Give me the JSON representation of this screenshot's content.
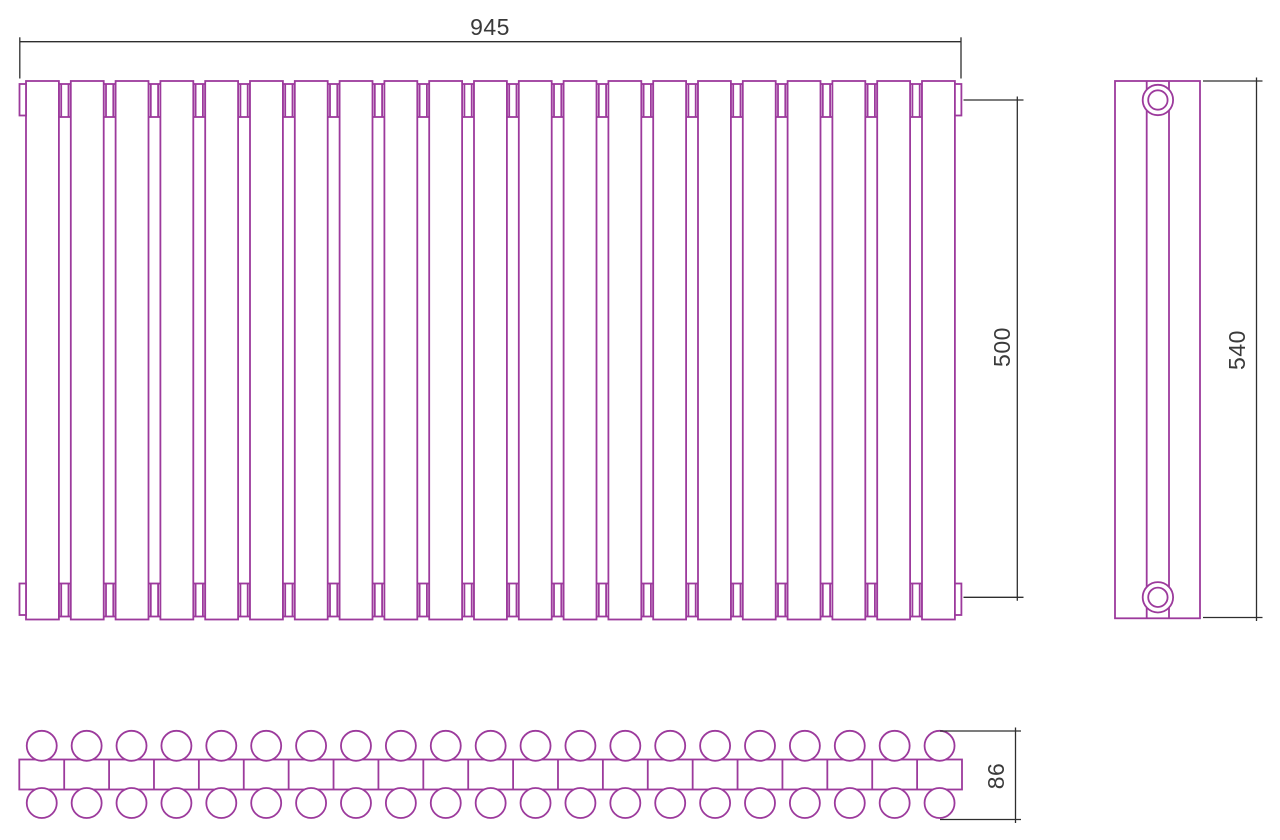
{
  "drawing_type": "radiator-three-view-technical-drawing",
  "dimensions": {
    "overall_width": "945",
    "axis_distance": "500",
    "overall_height": "540",
    "depth": "86"
  },
  "colors": {
    "line": "#9c3a9c",
    "dimension_line": "#2e2e2e",
    "dimension_text": "#3a3a3a",
    "background": "#ffffff"
  },
  "geometry": {
    "front": {
      "sections": 21,
      "col_left": 26,
      "col_w": 32.9,
      "gap": 11.9,
      "top": 81,
      "bottom": 619.5,
      "conn_top_y": 84,
      "conn_bottom_y": 583.5,
      "conn_h": 33,
      "conn_inset": 2.3,
      "tab_w": 6.5,
      "tab_left_x": 19.5,
      "tab_right_x": 954.9,
      "tab_top_y": 84,
      "tab_bottom_y": 583.5,
      "tab_h": 31.5
    },
    "side": {
      "x": 1115,
      "w": 85,
      "top": 81,
      "bottom": 618.3,
      "inner_line1": 1146.7,
      "inner_line2": 1169,
      "circle_cx": 1157.9,
      "circle_cy_top": 100,
      "circle_cy_bottom": 597.3,
      "r_outer": 15.2,
      "r_inner": 9.7
    },
    "bottom": {
      "sections": 21,
      "x": 19.3,
      "right": 962,
      "band_top": 759.5,
      "band_h": 30,
      "tube_r": 15,
      "cy_top": 745.8,
      "cy_bottom": 803
    },
    "dims": {
      "width": {
        "y": 41.7,
        "x1": 19.8,
        "x2": 961,
        "ext_y1": 37.3,
        "ext_y2": 78.5
      },
      "axis": {
        "x": 1017.3,
        "y1": 100,
        "y2": 597.3,
        "ext_x1": 963.5,
        "ext_x2": 1023.5
      },
      "height": {
        "x": 1256.5,
        "y1": 81,
        "y2": 617.5,
        "ext_x1": 1203,
        "ext_x2": 1262.5
      },
      "depth": {
        "x": 1015.5,
        "y1": 731,
        "y2": 819.5,
        "ext_x1": 940,
        "ext_x2": 1021
      }
    },
    "stroke_w_line": 1.8,
    "stroke_w_dim": 1.3
  }
}
